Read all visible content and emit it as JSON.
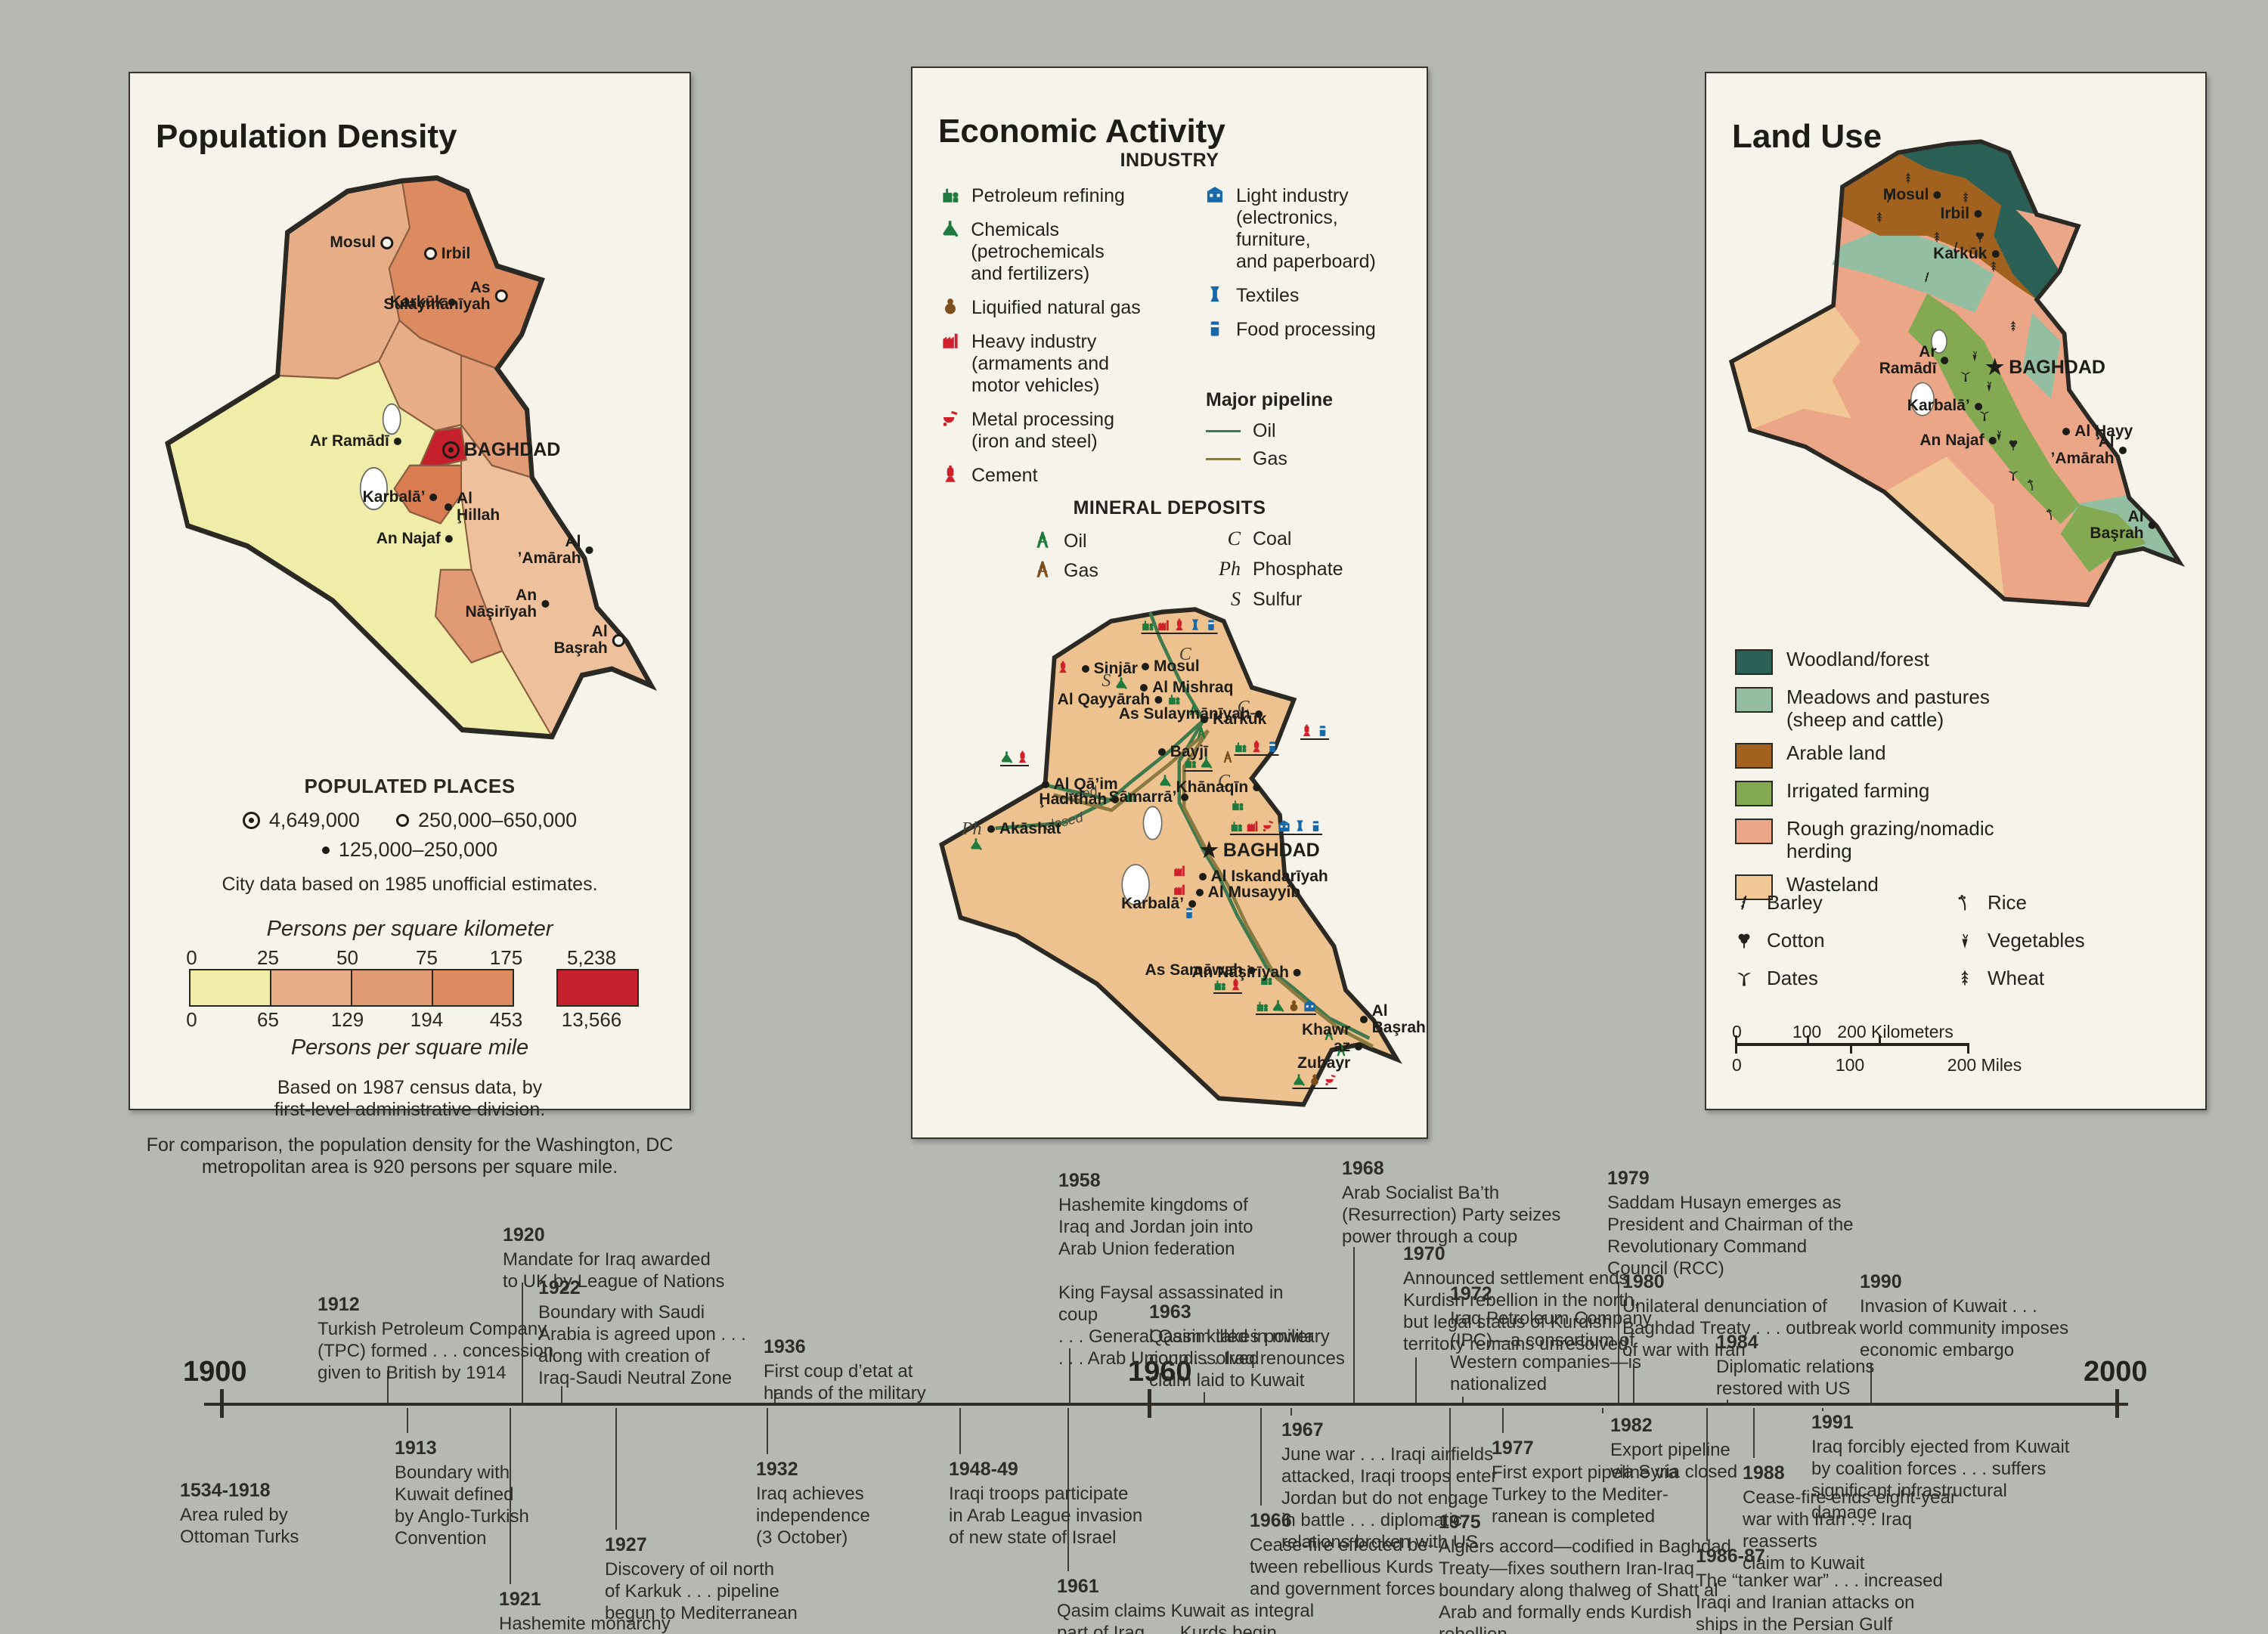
{
  "page": {
    "background": "#b6b8b4"
  },
  "population": {
    "title": "Population Density",
    "cities": [
      {
        "name": "Mosul"
      },
      {
        "name": "Irbil"
      },
      {
        "name": "As\nSulaymānīyah"
      },
      {
        "name": "Karkūk"
      },
      {
        "name": "Ar Ramādī"
      },
      {
        "name": "BAGHDAD"
      },
      {
        "name": "Karbalā’"
      },
      {
        "name": "Al\nḨillah"
      },
      {
        "name": "An Najaf"
      },
      {
        "name": "Al ’Amārah"
      },
      {
        "name": "An\nNāşirīyah"
      },
      {
        "name": "Al Başrah"
      }
    ],
    "legend": {
      "places_heading": "POPULATED PLACES",
      "sym1": "4,649,000",
      "sym2": "250,000–650,000",
      "sym3": "125,000–250,000",
      "city_note": "City data based on 1985 unofficial estimates.",
      "km_title": "Persons per square kilometer",
      "mi_title": "Persons per square mile",
      "km_labels": [
        "0",
        "25",
        "50",
        "75",
        "175",
        "5,238"
      ],
      "mi_labels": [
        "0",
        "65",
        "129",
        "194",
        "453",
        "13,566"
      ],
      "ramp_colors": [
        "#f0eda9",
        "#e6ad87",
        "#e19b74",
        "#dc8a60",
        "#c5202c"
      ],
      "census_note": "Based on 1987 census data, by\nfirst-level administrative division.",
      "comparison_note": "For comparison, the population density for the Washington, DC\nmetropolitan area is 920 persons per square mile."
    }
  },
  "economic": {
    "title": "Economic Activity",
    "industry_heading": "INDUSTRY",
    "industry_left": [
      {
        "label": "Petroleum refining"
      },
      {
        "label": "Chemicals (petrochemicals\nand fertilizers)"
      },
      {
        "label": "Liquified natural gas"
      },
      {
        "label": "Heavy industry\n(armaments and\nmotor vehicles)"
      },
      {
        "label": "Metal processing\n(iron and steel)"
      },
      {
        "label": "Cement"
      }
    ],
    "industry_right": [
      {
        "label": "Light industry\n(electronics, furniture,\nand paperboard)"
      },
      {
        "label": "Textiles"
      },
      {
        "label": "Food processing"
      }
    ],
    "pipeline_heading": "Major pipeline",
    "pipeline_oil": "Oil",
    "pipeline_gas": "Gas",
    "pipeline_oil_color": "#3f7a4e",
    "pipeline_gas_color": "#8a7a42",
    "minerals_heading": "MINERAL DEPOSITS",
    "mineral_oil": "Oil",
    "mineral_gas": "Gas",
    "mineral_letters": [
      {
        "symbol": "C",
        "label": "Coal"
      },
      {
        "symbol": "Ph",
        "label": "Phosphate"
      },
      {
        "symbol": "S",
        "label": "Sulfur"
      }
    ],
    "closed_label": "closed",
    "cities": [
      {
        "name": "Sinjār"
      },
      {
        "name": "Mosul"
      },
      {
        "name": "Al Mishraq"
      },
      {
        "name": "Al Qayyārah"
      },
      {
        "name": "As Sulaymānīyah"
      },
      {
        "name": "Karkūk"
      },
      {
        "name": "Bayjī"
      },
      {
        "name": "Al Qā’im"
      },
      {
        "name": "Akāshāt"
      },
      {
        "name": "Ḩadīthah"
      },
      {
        "name": "Khānaqīn"
      },
      {
        "name": "Sāmarrā’"
      },
      {
        "name": "BAGHDAD"
      },
      {
        "name": "Al Iskandarīyah"
      },
      {
        "name": "Al Musayyib"
      },
      {
        "name": "Karbalā’"
      },
      {
        "name": "As Samāwah"
      },
      {
        "name": "An Nāşirīyah"
      },
      {
        "name": "Al Başrah"
      },
      {
        "name": "Khawr az Zubayr"
      }
    ],
    "map_letters": [
      {
        "symbol": "S"
      },
      {
        "symbol": "C"
      },
      {
        "symbol": "C"
      },
      {
        "symbol": "C"
      },
      {
        "symbol": "Ph"
      }
    ]
  },
  "landuse": {
    "title": "Land Use",
    "legend": [
      {
        "label": "Woodland/forest",
        "color": "#2a6056"
      },
      {
        "label": "Meadows and pastures\n(sheep and cattle)",
        "color": "#93bea1"
      },
      {
        "label": "Arable land",
        "color": "#a2621f"
      },
      {
        "label": "Irrigated farming",
        "color": "#83a952"
      },
      {
        "label": "Rough grazing/nomadic\nherding",
        "color": "#eba687"
      },
      {
        "label": "Wasteland",
        "color": "#f0c795"
      }
    ],
    "crops_left": [
      {
        "label": "Barley"
      },
      {
        "label": "Cotton"
      },
      {
        "label": "Dates"
      }
    ],
    "crops_right": [
      {
        "label": "Rice"
      },
      {
        "label": "Vegetables"
      },
      {
        "label": "Wheat"
      }
    ],
    "scale_km": [
      "0",
      "100",
      "200 Kilometers"
    ],
    "scale_mi": [
      "0",
      "100",
      "200 Miles"
    ],
    "cities": [
      {
        "name": "Mosul"
      },
      {
        "name": "Irbil"
      },
      {
        "name": "Karkūk"
      },
      {
        "name": "Ar\nRamādī"
      },
      {
        "name": "BAGHDAD"
      },
      {
        "name": "Karbalā’"
      },
      {
        "name": "An Najaf"
      },
      {
        "name": "Al Ḩayy"
      },
      {
        "name": "Al\n’Amārah"
      },
      {
        "name": "Al Başrah"
      }
    ]
  },
  "timeline": {
    "years": [
      "1900",
      "1960",
      "2000"
    ],
    "events": [
      {
        "year": "1534-1918",
        "text": "Area ruled by\nOttoman Turks"
      },
      {
        "year": "1912",
        "text": "Turkish Petroleum Company\n(TPC) formed . . . concession\ngiven to British by 1914"
      },
      {
        "year": "1913",
        "text": "Boundary with\nKuwait defined\nby Anglo-Turkish\nConvention"
      },
      {
        "year": "1920",
        "text": "Mandate for Iraq awarded\nto UK by League of Nations"
      },
      {
        "year": "1921",
        "text": "Hashemite monarchy\nestablished under\nKing Faysal"
      },
      {
        "year": "1922",
        "text": "Boundary with Saudi\nArabia is agreed upon . . .\nalong with creation of\nIraq-Saudi Neutral Zone"
      },
      {
        "year": "1927",
        "text": "Discovery of oil north\nof Karkuk . . . pipeline\nbegun to Mediterranean"
      },
      {
        "year": "1932",
        "text": "Iraq achieves\nindependence\n(3 October)"
      },
      {
        "year": "1936",
        "text": "First coup d’etat at\nhands of the military"
      },
      {
        "year": "1948-49",
        "text": "Iraqi troops participate\nin Arab League invasion\nof new state of Israel"
      },
      {
        "year": "1958",
        "text": "Hashemite kingdoms of\nIraq and Jordan join into\nArab Union federation\n\nKing Faysal assassinated in coup\n. . . General Qasim takes power\n. . . Arab Union dissolved"
      },
      {
        "year": "1961",
        "text": "Qasim claims Kuwait as integral\npart of Iraq . . . Kurds begin\narmed revolt against Baghdad"
      },
      {
        "year": "1963",
        "text": "Qasim killed in military\ncoup . . . Iraq renounces\nclaim laid to Kuwait"
      },
      {
        "year": "1966",
        "text": "Cease-fire effected be-\ntween rebellious Kurds\nand government forces"
      },
      {
        "year": "1967",
        "text": "June war . . . Iraqi airfields\nattacked, Iraqi troops enter\nJordan but do not engage\nin battle . . . diplomatic\nrelations broken with US"
      },
      {
        "year": "1968",
        "text": "Arab Socialist Ba’th\n(Resurrection) Party seizes\npower through a coup"
      },
      {
        "year": "1970",
        "text": "Announced settlement ends\nKurdish rebellion in the north,\nbut legal status of Kurdish\nterritory remains unresolved"
      },
      {
        "year": "1972",
        "text": "Iraq Petroleum Company\n(IPC)—a consortium of\nWestern companies—is\nnationalized"
      },
      {
        "year": "1975",
        "text": "Algiers accord—codified in Baghdad\nTreaty—fixes southern Iran-Iraq\nboundary along thalweg of Shatt al\nArab and formally ends Kurdish\nrebellion"
      },
      {
        "year": "1977",
        "text": "First export pipeline via\nTurkey to the Mediter-\nranean is completed"
      },
      {
        "year": "1979",
        "text": "Saddam Husayn emerges as\nPresident and Chairman of the\nRevolutionary Command\nCouncil (RCC)"
      },
      {
        "year": "1980",
        "text": "Unilateral denunciation of\nBaghdad Treaty . . . outbreak\nof war with Iran"
      },
      {
        "year": "1982",
        "text": "Export pipeline\nvia Syria closed"
      },
      {
        "year": "1984",
        "text": "Diplomatic relations\nrestored with US"
      },
      {
        "year": "1986-87",
        "text": "The “tanker war” . . . increased\nIraqi and Iranian attacks on\nships in the Persian Gulf"
      },
      {
        "year": "1988",
        "text": "Cease-fire ends eight-year\nwar with Iran . . . Iraq reasserts\nclaim to Kuwait"
      },
      {
        "year": "1990",
        "text": "Invasion of Kuwait . . .\nworld community imposes\neconomic embargo"
      },
      {
        "year": "1991",
        "text": "Iraq forcibly ejected from Kuwait\nby coalition forces . . . suffers\nsignificant infrastructural damage"
      }
    ]
  }
}
